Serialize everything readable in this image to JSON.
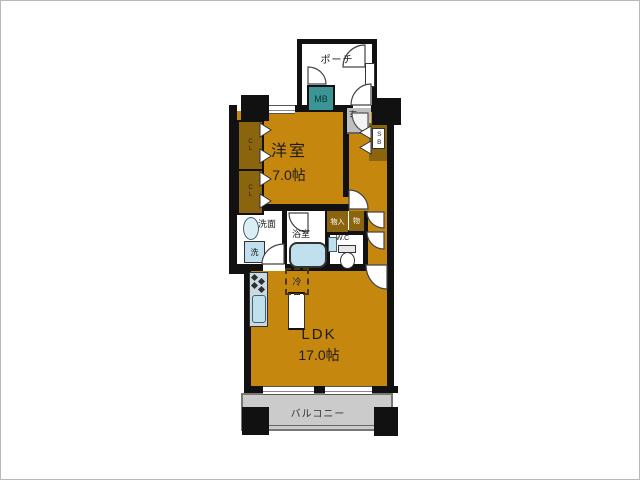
{
  "colors": {
    "wall": "#111111",
    "floor": "#C6870F",
    "storage": "#8A650E",
    "meter-box": "#3D9494",
    "entry-gray": "#C0C0C0",
    "balcony-gray": "#CBCBCB",
    "fixture": "#BFE0EC",
    "counter": "#C9DAE2"
  },
  "labels": {
    "porch": "ポーチ",
    "meter_box": "MB",
    "entry": "玄",
    "shoe_box": "SB",
    "closet_upper": "CL",
    "closet_lower": "CL",
    "western_room": "洋室",
    "western_room_size": "7.0帖",
    "washroom": "洗面",
    "washing_machine": "洗",
    "bathroom": "浴室",
    "storage_in": "物入",
    "storage_small": "物",
    "toilet": "W.C",
    "refrigerator": "冷",
    "ldk": "LDK",
    "ldk_size": "17.0帖",
    "balcony": "バルコニー"
  }
}
